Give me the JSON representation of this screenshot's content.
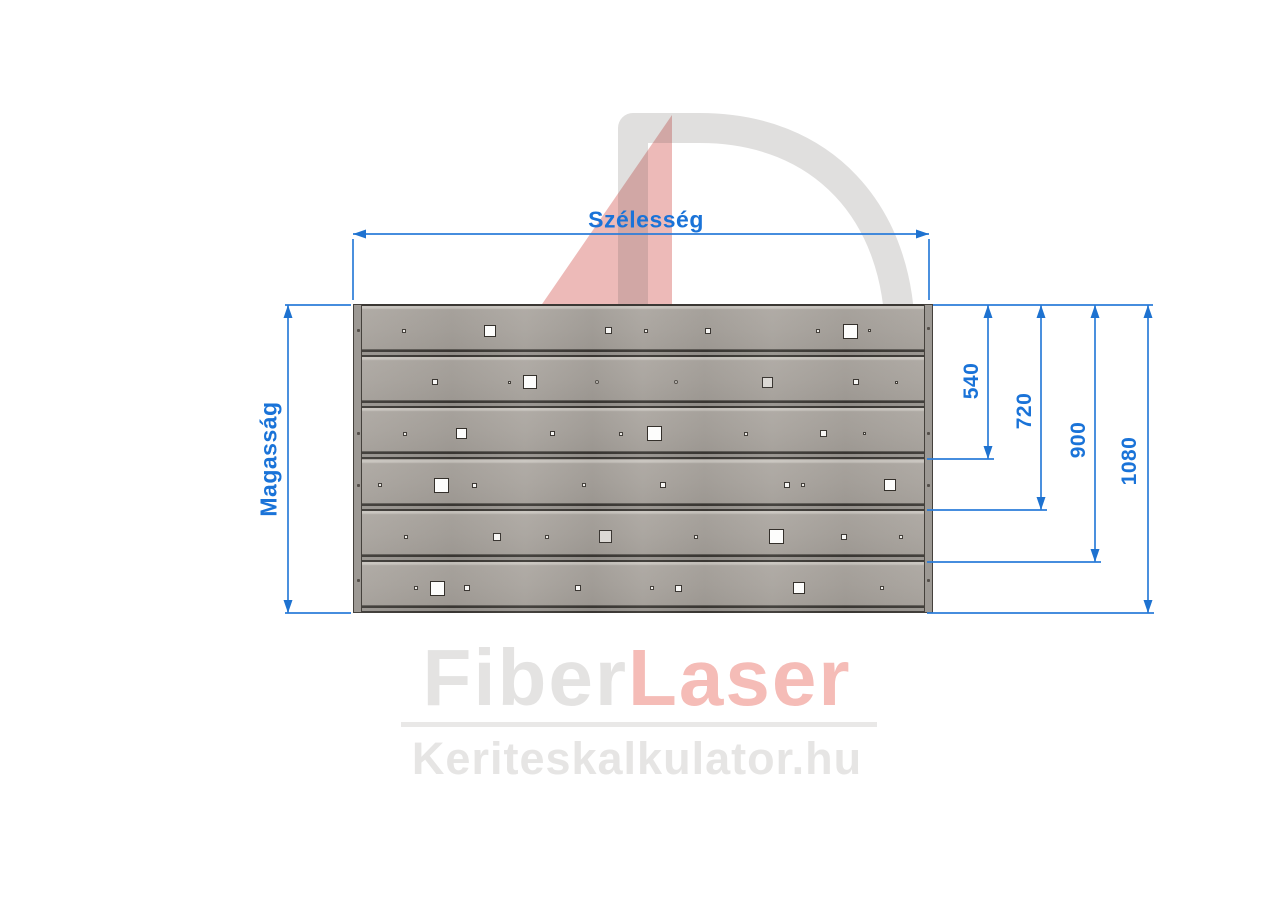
{
  "dimensions": {
    "width_label": "Szélesség",
    "height_label": "Magasság",
    "right_values": [
      "540",
      "720",
      "900",
      "1080"
    ]
  },
  "watermark": {
    "number": "4",
    "letter": "D",
    "text": "Kerítésrendszer",
    "number_color": "#d6635d",
    "letter_color": "#64605a"
  },
  "logo": {
    "part1": "Fiber",
    "part2": "Laser",
    "subtitle": "Keriteskalkulator.hu",
    "part1_color": "#e4e3e2",
    "part2_color": "#f5bcb7"
  },
  "colors": {
    "dimension_blue": "#1a73d8",
    "slat_gray": "#a8a39d",
    "post_gray": "#9d9994",
    "background": "#ffffff"
  },
  "panel": {
    "slat_count": 6,
    "slat_height": 51.17,
    "squares": [
      {
        "x": 404,
        "y": 330.5,
        "s": 4,
        "v": "t"
      },
      {
        "x": 490,
        "y": 330.5,
        "s": 12,
        "v": "w"
      },
      {
        "x": 608,
        "y": 330.5,
        "s": 7,
        "v": "s"
      },
      {
        "x": 646,
        "y": 330.5,
        "s": 4,
        "v": "t"
      },
      {
        "x": 708,
        "y": 330.5,
        "s": 6,
        "v": "s"
      },
      {
        "x": 818,
        "y": 330.5,
        "s": 4,
        "v": "t"
      },
      {
        "x": 850,
        "y": 331,
        "s": 15,
        "v": "w"
      },
      {
        "x": 869,
        "y": 330.5,
        "s": 3,
        "v": "t"
      },
      {
        "x": 435,
        "y": 382,
        "s": 6,
        "v": "s"
      },
      {
        "x": 509,
        "y": 382,
        "s": 3,
        "v": "t"
      },
      {
        "x": 530,
        "y": 382,
        "s": 14,
        "v": "w"
      },
      {
        "x": 597,
        "y": 382,
        "s": 4,
        "v": "d"
      },
      {
        "x": 676,
        "y": 382,
        "s": 4,
        "v": "d"
      },
      {
        "x": 767,
        "y": 382,
        "s": 11,
        "v": "g"
      },
      {
        "x": 856,
        "y": 382,
        "s": 6,
        "v": "s"
      },
      {
        "x": 896,
        "y": 382,
        "s": 3,
        "v": "t"
      },
      {
        "x": 405,
        "y": 433.5,
        "s": 4,
        "v": "t"
      },
      {
        "x": 461,
        "y": 433.5,
        "s": 11,
        "v": "w"
      },
      {
        "x": 552,
        "y": 433.5,
        "s": 5,
        "v": "s"
      },
      {
        "x": 621,
        "y": 433.5,
        "s": 4,
        "v": "t"
      },
      {
        "x": 654,
        "y": 433.5,
        "s": 15,
        "v": "w"
      },
      {
        "x": 746,
        "y": 433.5,
        "s": 4,
        "v": "t"
      },
      {
        "x": 823,
        "y": 433.5,
        "s": 7,
        "v": "s"
      },
      {
        "x": 864,
        "y": 433.5,
        "s": 3,
        "v": "t"
      },
      {
        "x": 380,
        "y": 485,
        "s": 4,
        "v": "t"
      },
      {
        "x": 441,
        "y": 485,
        "s": 15,
        "v": "w"
      },
      {
        "x": 474,
        "y": 485,
        "s": 5,
        "v": "s"
      },
      {
        "x": 584,
        "y": 485,
        "s": 4,
        "v": "t"
      },
      {
        "x": 663,
        "y": 485,
        "s": 6,
        "v": "s"
      },
      {
        "x": 787,
        "y": 485,
        "s": 6,
        "v": "s"
      },
      {
        "x": 803,
        "y": 485,
        "s": 4,
        "v": "t"
      },
      {
        "x": 890,
        "y": 485,
        "s": 12,
        "v": "w"
      },
      {
        "x": 406,
        "y": 536.5,
        "s": 4,
        "v": "t"
      },
      {
        "x": 497,
        "y": 536.5,
        "s": 8,
        "v": "s"
      },
      {
        "x": 547,
        "y": 536.5,
        "s": 4,
        "v": "t"
      },
      {
        "x": 605,
        "y": 536.5,
        "s": 13,
        "v": "g"
      },
      {
        "x": 696,
        "y": 536.5,
        "s": 4,
        "v": "t"
      },
      {
        "x": 776,
        "y": 536.5,
        "s": 15,
        "v": "w"
      },
      {
        "x": 844,
        "y": 536.5,
        "s": 6,
        "v": "s"
      },
      {
        "x": 901,
        "y": 536.5,
        "s": 4,
        "v": "t"
      },
      {
        "x": 416,
        "y": 588,
        "s": 4,
        "v": "t"
      },
      {
        "x": 437,
        "y": 588,
        "s": 15,
        "v": "w"
      },
      {
        "x": 467,
        "y": 588,
        "s": 6,
        "v": "s"
      },
      {
        "x": 578,
        "y": 588,
        "s": 6,
        "v": "s"
      },
      {
        "x": 652,
        "y": 588,
        "s": 4,
        "v": "t"
      },
      {
        "x": 678,
        "y": 588,
        "s": 7,
        "v": "s"
      },
      {
        "x": 799,
        "y": 588,
        "s": 12,
        "v": "w"
      },
      {
        "x": 882,
        "y": 588,
        "s": 4,
        "v": "t"
      }
    ],
    "post_dots": [
      {
        "x": 358.5,
        "y": 330
      },
      {
        "x": 358.5,
        "y": 433
      },
      {
        "x": 358.5,
        "y": 485
      },
      {
        "x": 358.5,
        "y": 580
      },
      {
        "x": 928.5,
        "y": 328
      },
      {
        "x": 928.5,
        "y": 433
      },
      {
        "x": 928.5,
        "y": 485
      },
      {
        "x": 928.5,
        "y": 580
      }
    ]
  }
}
